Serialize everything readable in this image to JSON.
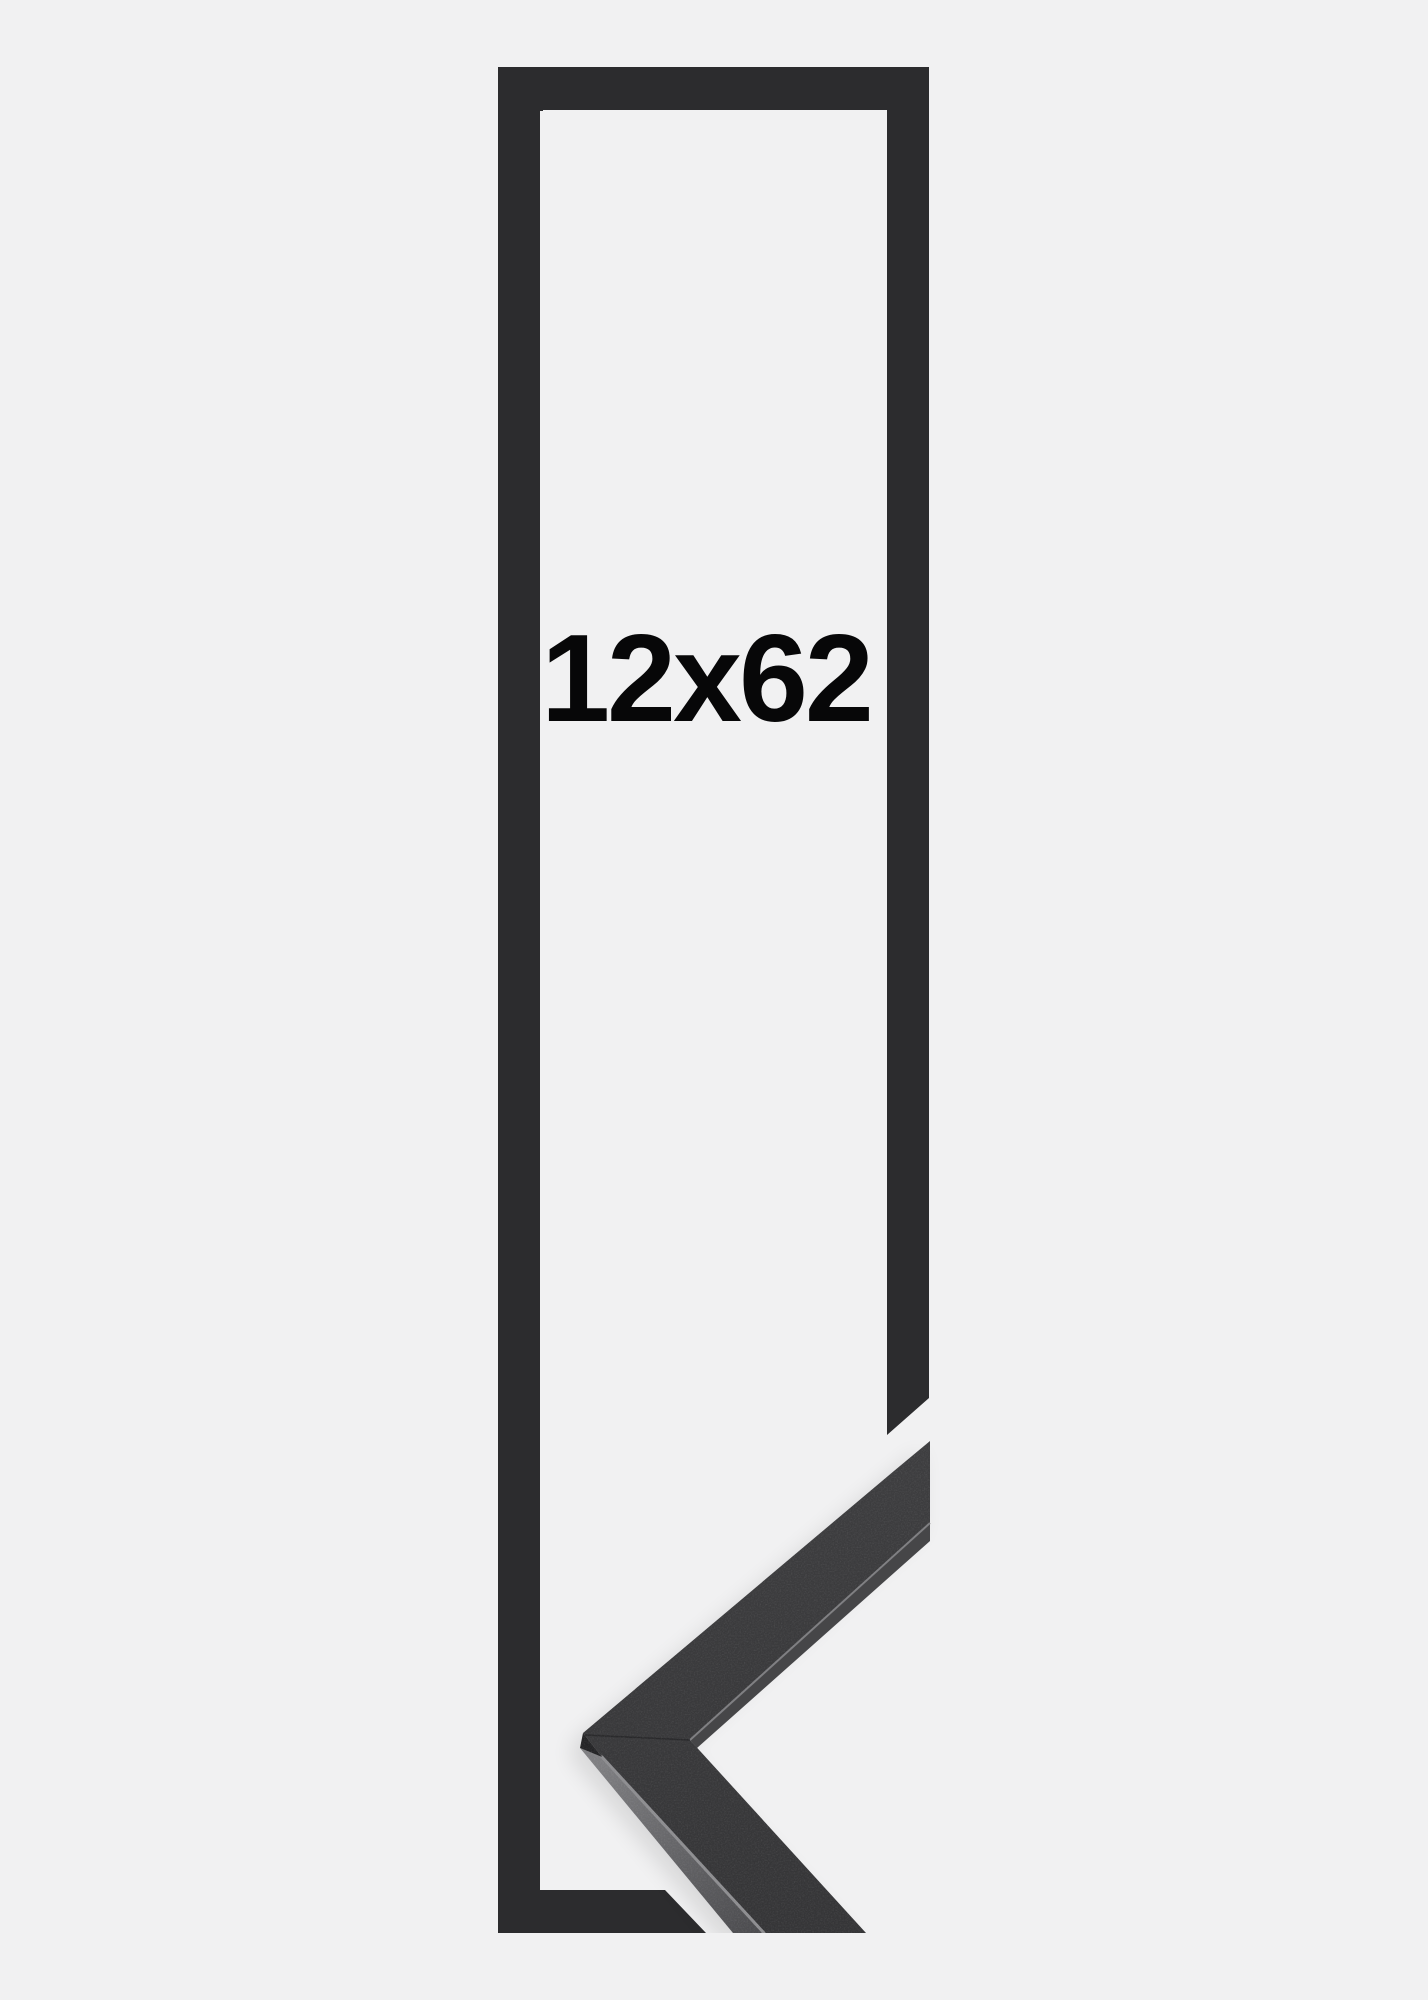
{
  "product_image": {
    "size_label": "12x62",
    "colors": {
      "background": "#f1f1f2",
      "frame_graphic": "#2c2c2e",
      "moulding_face_top": "#3e3e40",
      "moulding_face_bottom": "#353537",
      "moulding_side_top": "#7e7e81",
      "moulding_side_bottom": "#4a4a4d",
      "edge_highlight": "#8d8d90",
      "inner_lip": "#464648",
      "inner_lip_line": "#858588",
      "apex_cap": "#242426",
      "miter_seam": "#262628",
      "shadow": "#000000",
      "label_text": "#070708"
    }
  }
}
